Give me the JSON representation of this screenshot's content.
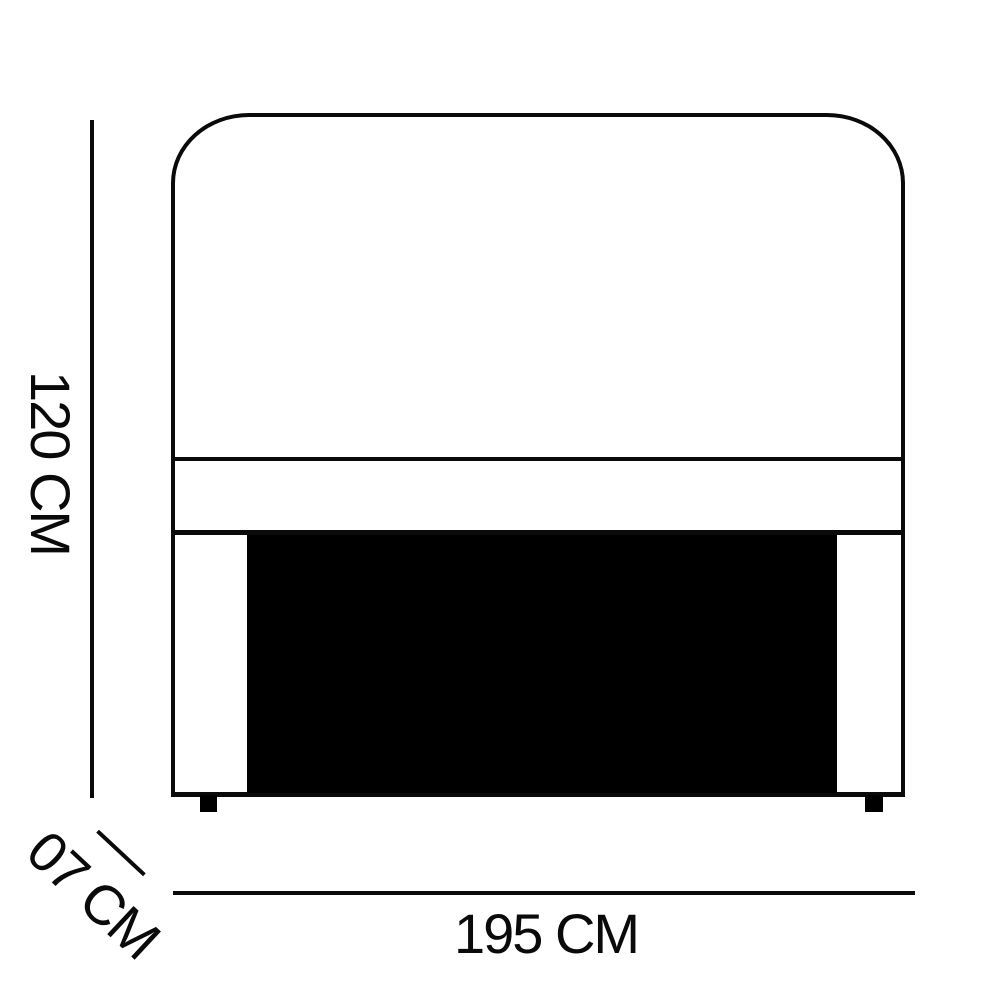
{
  "diagram": {
    "kind": "furniture-dimension-drawing",
    "dimensions": {
      "height": {
        "label": "120 CM",
        "value": 120,
        "unit": "CM"
      },
      "width": {
        "label": "195 CM",
        "value": 195,
        "unit": "CM"
      },
      "depth": {
        "label": "07 CM",
        "value": 7,
        "unit": "CM"
      }
    },
    "colors": {
      "line": "#0a0a0a",
      "panel_fill": "#000000",
      "background": "#ffffff"
    }
  }
}
